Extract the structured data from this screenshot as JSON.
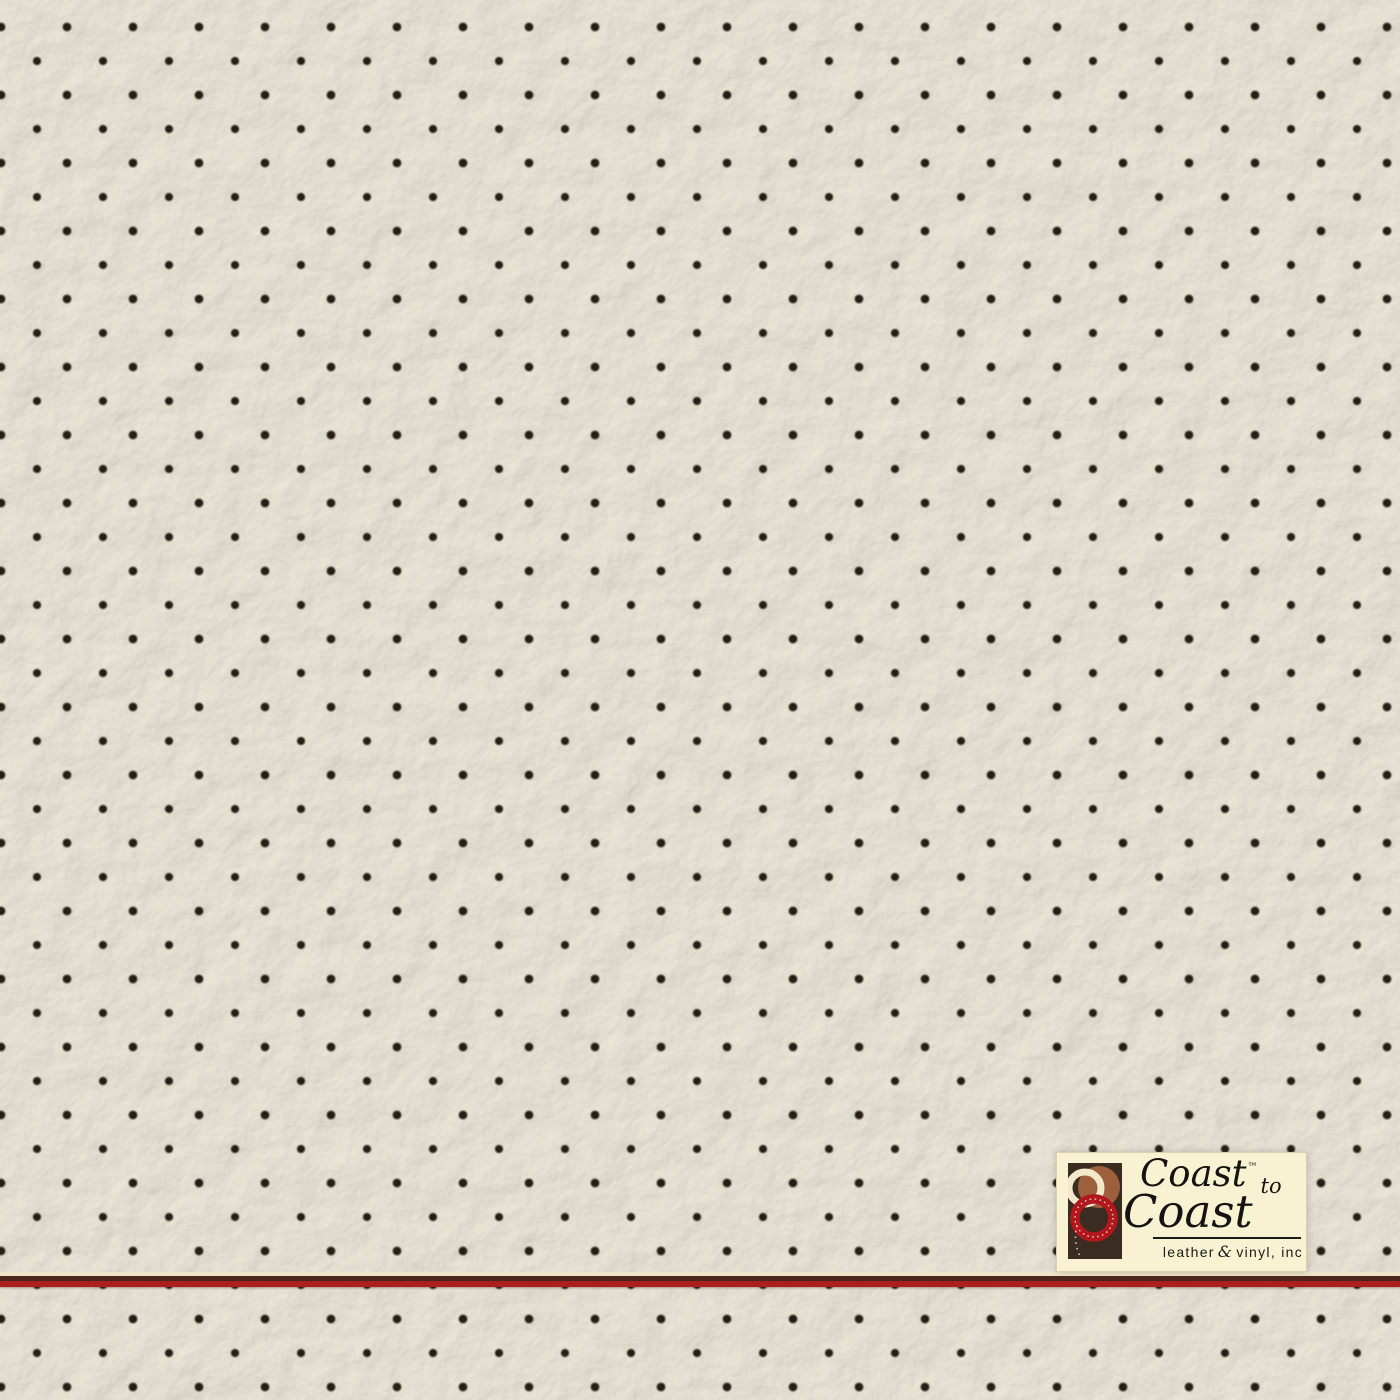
{
  "photo": {
    "description": "Close-up photograph of cream perforated leather upholstery",
    "leather_color": "#dbd7cb",
    "hole_color": "#241e15",
    "perforation_grid": {
      "column_spacing_px": 66,
      "row_spacing_px": 34,
      "pattern": "diamond offset"
    }
  },
  "accent_line": {
    "highlight_color": "#ece5c8",
    "shadow_color": "#4e2620",
    "red_color": "#ad1f1c"
  },
  "logo": {
    "coast1": "Coast",
    "tm": "™",
    "to": "to",
    "coast2": "Coast",
    "tagline_leather": "leather",
    "tagline_amp": "&",
    "tagline_vinyl": "vinyl, inc",
    "background_color": "#f8f1d2",
    "text_color": "#161412",
    "mark_colors": {
      "panel": "#3b2c21",
      "brown_circle": "#9d5f3c",
      "cream_ring": "#f2e9cb",
      "red_ring": "#b2171d",
      "stitch": "#f6efdc"
    }
  }
}
